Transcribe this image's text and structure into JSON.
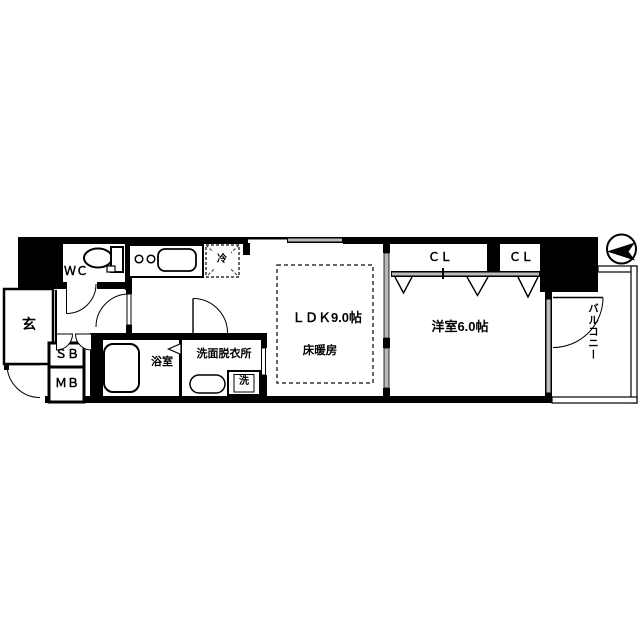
{
  "labels": {
    "entrance": "玄",
    "wc": "ＷＣ",
    "shoe_box": "ＳＢ",
    "meter_box": "ＭＢ",
    "bathroom": "浴室",
    "washroom": "洗面脱衣所",
    "washing_machine": "洗",
    "refrigerator": "冷",
    "ldk": "ＬＤＫ9.0帖",
    "floor_heating": "床暖房",
    "western_room": "洋室6.0帖",
    "closet_left": "ＣＬ",
    "closet_right": "ＣＬ",
    "balcony": "バルコニー"
  },
  "colors": {
    "wall": "#000000",
    "background": "#ffffff",
    "window_fill": "#bdbdbd",
    "sliding_panel": "#b8b8b8",
    "dashed_line": "#333333"
  }
}
